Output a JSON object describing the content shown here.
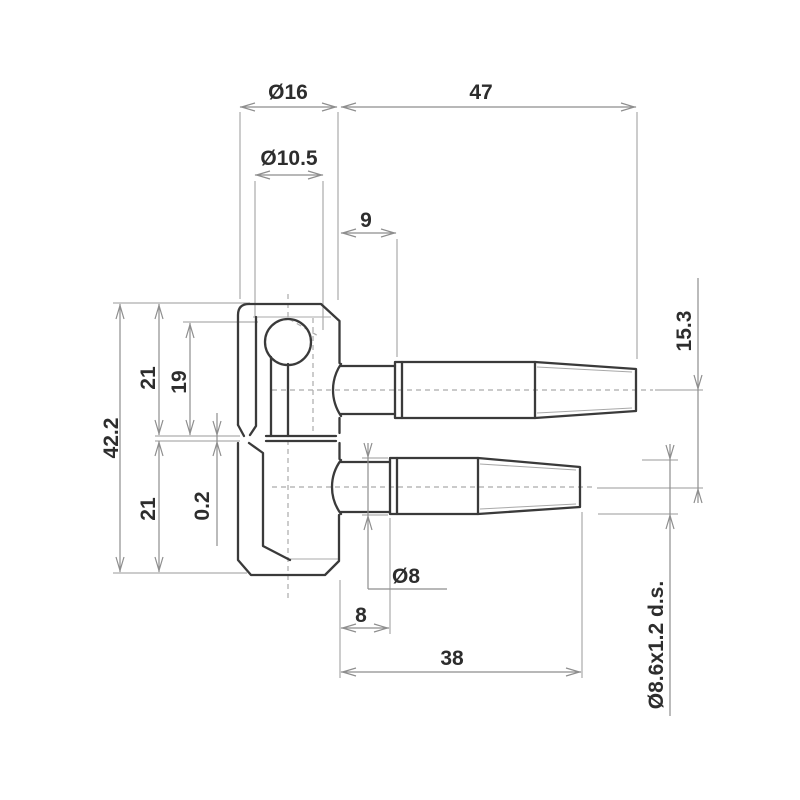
{
  "drawing": {
    "title": "hinge-technical-drawing",
    "colors": {
      "background": "#ffffff",
      "part_outline": "#3a3a3a",
      "dimension_lines": "#8e8e8e",
      "label_text": "#2d2d2d"
    },
    "dimensions": [
      {
        "id": "body-diameter",
        "label": "Ø16"
      },
      {
        "id": "upper-pin-length",
        "label": "47"
      },
      {
        "id": "bore-diameter",
        "label": "Ø10.5"
      },
      {
        "id": "upper-neck-length",
        "label": "9"
      },
      {
        "id": "pin-axis-offset",
        "label": "15.3"
      },
      {
        "id": "upper-half-height",
        "label": "21"
      },
      {
        "id": "ball-depth",
        "label": "19"
      },
      {
        "id": "total-height",
        "label": "42.2"
      },
      {
        "id": "lower-half-height",
        "label": "21"
      },
      {
        "id": "gap",
        "label": "0.2"
      },
      {
        "id": "lower-pin-diameter",
        "label": "Ø8"
      },
      {
        "id": "lower-neck-length",
        "label": "8"
      },
      {
        "id": "lower-pin-length",
        "label": "38"
      },
      {
        "id": "thread-spec",
        "label": "Ø8.6x1.2 d.s."
      }
    ]
  }
}
